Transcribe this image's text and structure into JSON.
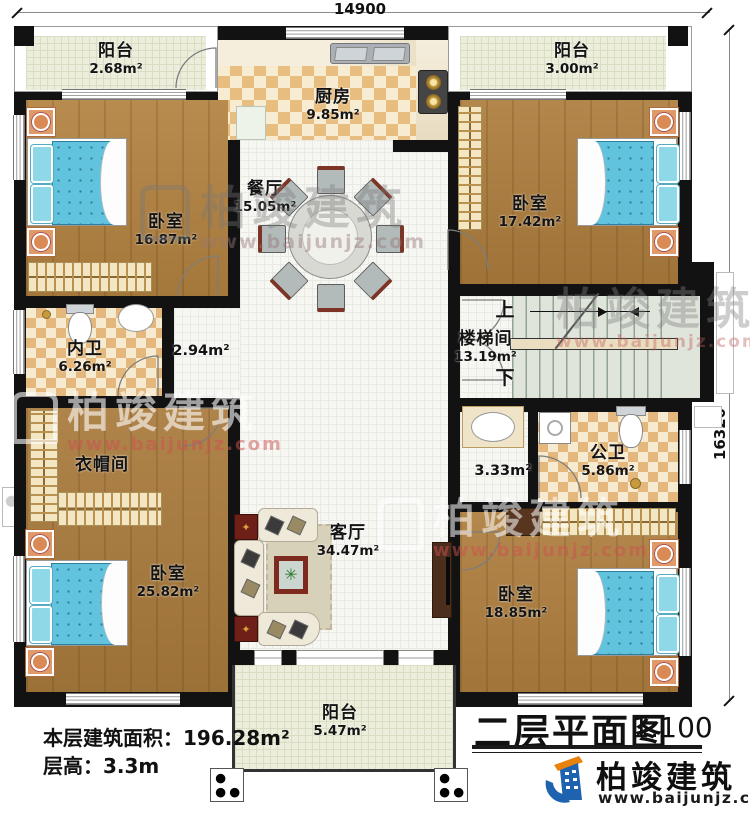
{
  "dimensions": {
    "top": "14900",
    "right": "16320"
  },
  "rooms": {
    "balcony_tl": {
      "name": "阳台",
      "area": "2.68m²"
    },
    "kitchen": {
      "name": "厨房",
      "area": "9.85m²"
    },
    "balcony_tr": {
      "name": "阳台",
      "area": "3.00m²"
    },
    "bedroom_tl": {
      "name": "卧室",
      "area": "16.87m²"
    },
    "dining": {
      "name": "餐厅",
      "area": "15.05m²"
    },
    "bedroom_tr": {
      "name": "卧室",
      "area": "17.42m²"
    },
    "bath_inner": {
      "name": "内卫",
      "area": "6.26m²"
    },
    "hall_left": {
      "area": "2.94m²"
    },
    "stairwell": {
      "name": "楼梯间",
      "area": "13.19m²",
      "up": "上",
      "down": "下"
    },
    "closet": {
      "name": "衣帽间"
    },
    "hall_right": {
      "area": "3.33m²"
    },
    "bath_public": {
      "name": "公卫",
      "area": "5.86m²"
    },
    "living": {
      "name": "客厅",
      "area": "34.47m²"
    },
    "bedroom_bl": {
      "name": "卧室",
      "area": "25.82m²"
    },
    "bedroom_br": {
      "name": "卧室",
      "area": "18.85m²"
    },
    "balcony_b": {
      "name": "阳台",
      "area": "5.47m²"
    }
  },
  "footer": {
    "line1": "本层建筑面积：196.28m²",
    "line2": "层高：3.3m"
  },
  "titleblock": {
    "title": "二层平面图",
    "scale": "1:100"
  },
  "brand": {
    "name": "柏竣建筑",
    "url": "www.baijunjz.com"
  },
  "watermark": {
    "name": "柏竣建筑",
    "url": "www.baijunjz.com"
  },
  "colors": {
    "wall": "#121212",
    "wood": "#b2813f",
    "checker": "#e7bd80",
    "tile": "#f6f6f3",
    "logo_blue": "#1f63b0",
    "logo_orange": "#e8820c",
    "bed": "#62c3de"
  }
}
